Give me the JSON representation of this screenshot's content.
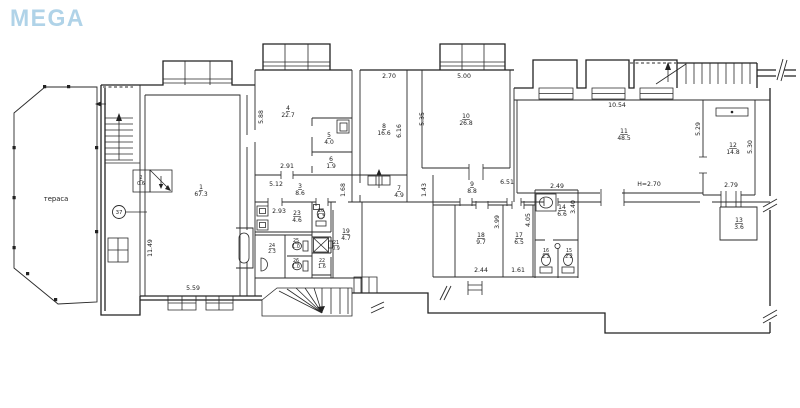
{
  "logo": {
    "text": "MEGA"
  },
  "plan": {
    "terrace_label": "тераса",
    "circle_label": "37",
    "rooms": [
      {
        "num": "1",
        "area": "67.3"
      },
      {
        "num": "2",
        "area": "0.6"
      },
      {
        "num": "3",
        "area": "8.6"
      },
      {
        "num": "4",
        "area": "22.7"
      },
      {
        "num": "5",
        "area": "4.0"
      },
      {
        "num": "6",
        "area": "1.9"
      },
      {
        "num": "7",
        "area": "4.9"
      },
      {
        "num": "8",
        "area": "16.6"
      },
      {
        "num": "9",
        "area": "8.8"
      },
      {
        "num": "10",
        "area": "26.8"
      },
      {
        "num": "11",
        "area": "48.5"
      },
      {
        "num": "12",
        "area": "14.8"
      },
      {
        "num": "13",
        "area": "3.6"
      },
      {
        "num": "14",
        "area": "6.6"
      },
      {
        "num": "15",
        "area": "2.2"
      },
      {
        "num": "16",
        "area": "2.2"
      },
      {
        "num": "17",
        "area": "6.5"
      },
      {
        "num": "18",
        "area": "9.7"
      },
      {
        "num": "19",
        "area": "4.7"
      },
      {
        "num": "20",
        "area": "1.3"
      },
      {
        "num": "21",
        "area": "0.9"
      },
      {
        "num": "22",
        "area": "1.6"
      },
      {
        "num": "23",
        "area": "4.6"
      },
      {
        "num": "24",
        "area": "2.3"
      },
      {
        "num": "25",
        "area": "1.0"
      },
      {
        "num": "26",
        "area": "1.0"
      }
    ],
    "dims": [
      "11.49",
      "5.59",
      "2.93",
      "5.88",
      "2.91",
      "5.12",
      "1.68",
      "2.70",
      "6.16",
      "5.35",
      "5.00",
      "1.43",
      "6.51",
      "2.49",
      "10.54",
      "5.29",
      "5.30",
      "2.79",
      "H=2.70",
      "3.99",
      "2.44",
      "4.05",
      "1.61",
      "3.40"
    ]
  }
}
